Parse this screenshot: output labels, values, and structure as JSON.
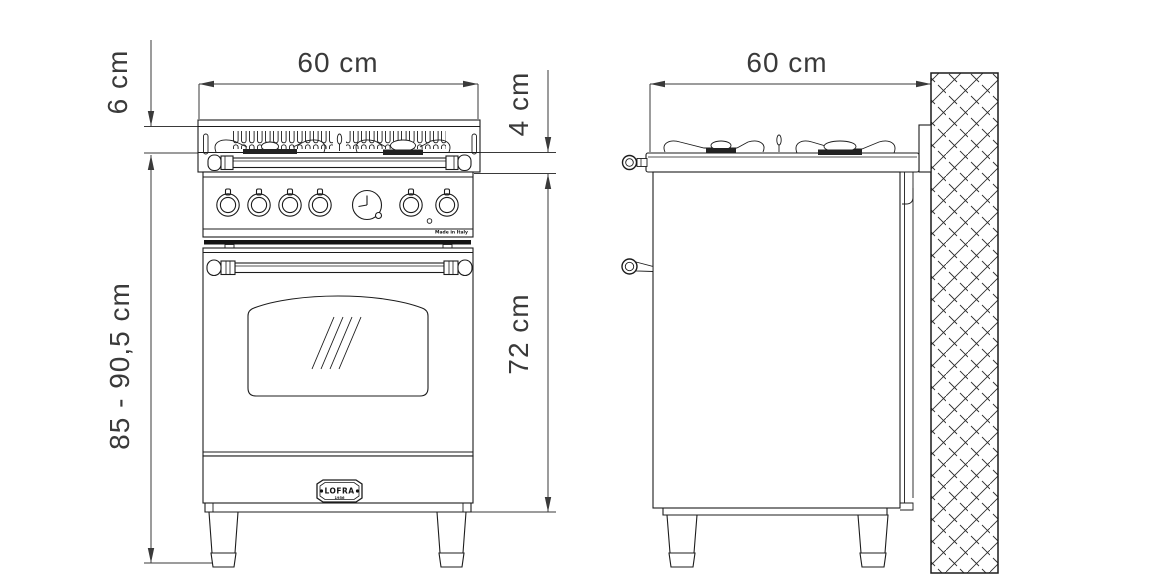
{
  "colors": {
    "background": "#ffffff",
    "drawing_line": "#1c1c1c",
    "dimension_line": "#3a3a3a",
    "burner_cap_fill": "#222222"
  },
  "dimensions": {
    "front_width": "60 cm",
    "hob_rim_height": "6 cm",
    "worktop_thickness": "4 cm",
    "total_height_range": "85 - 90,5 cm",
    "body_height": "72 cm",
    "side_depth": "60 cm"
  },
  "badge": {
    "brand": "LOFRA",
    "year": "1956"
  },
  "control_panel": {
    "microtext": "Made in Italy"
  }
}
